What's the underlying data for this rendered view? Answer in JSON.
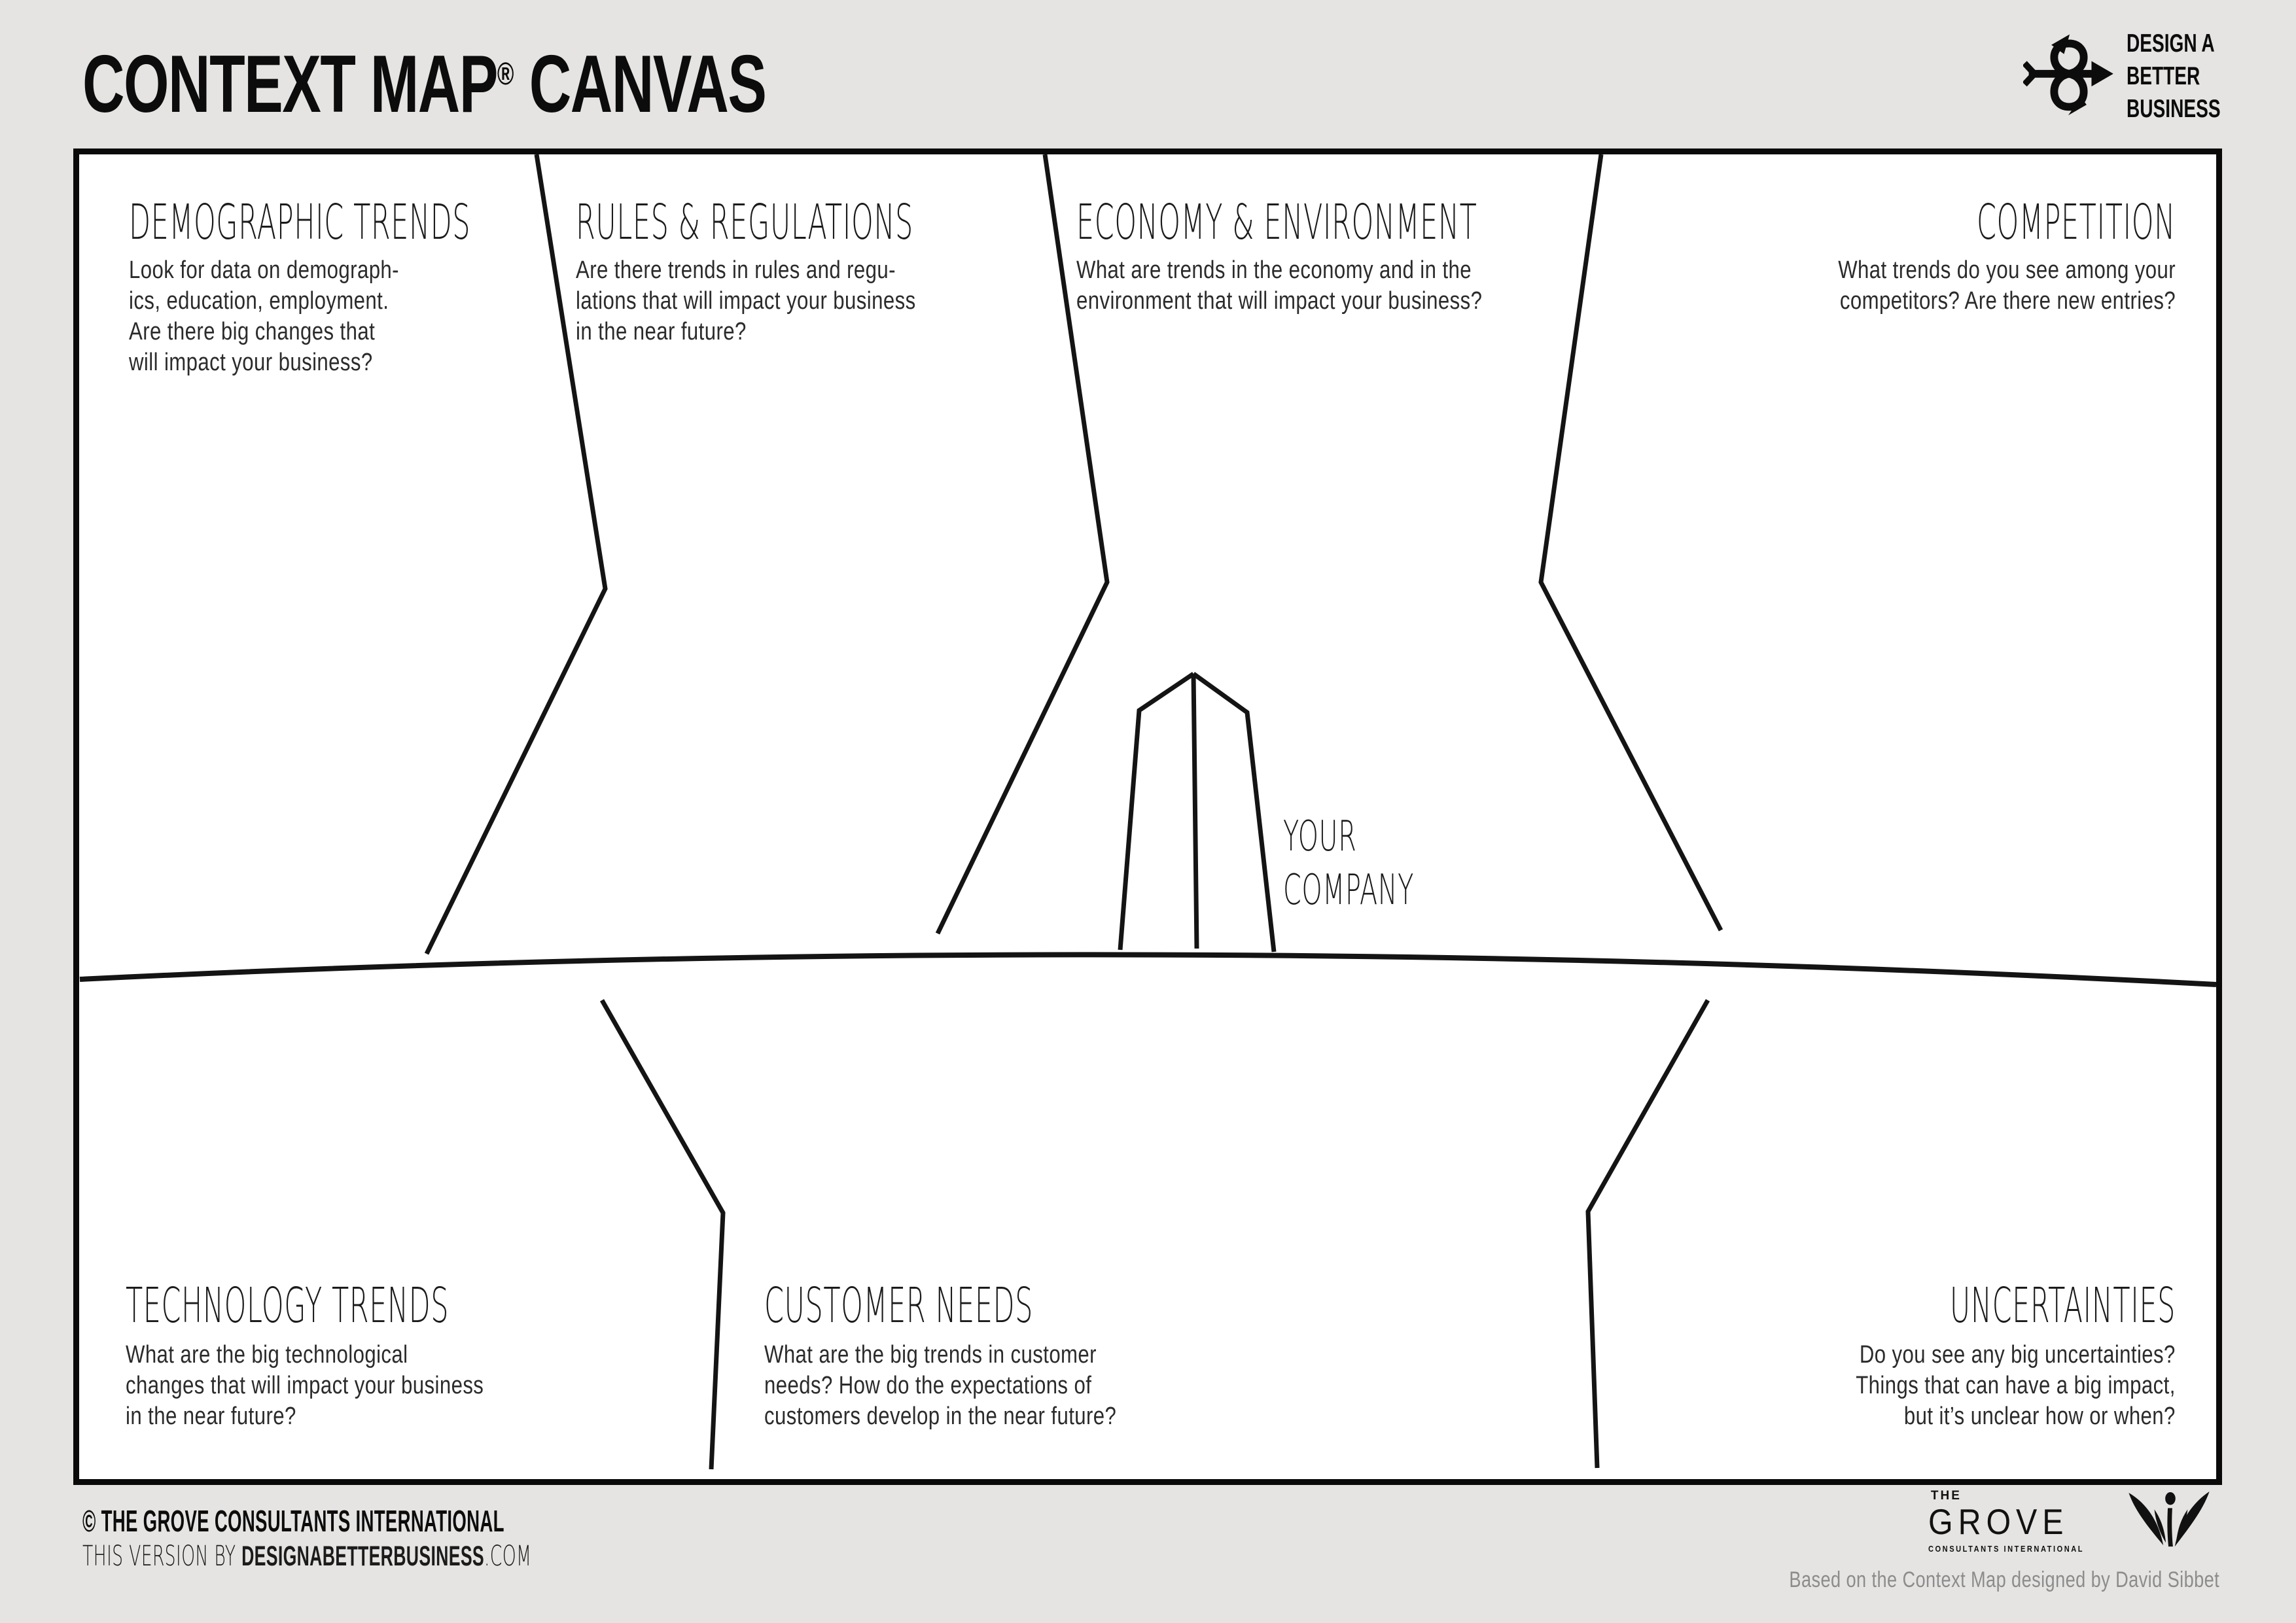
{
  "colors": {
    "background": "#e5e4e2",
    "canvas": "#ffffff",
    "line": "#141414",
    "text": "#1d1d1d",
    "credit_gray": "#8c8c8c"
  },
  "header": {
    "title_main": "CONTEXT MAP",
    "registered": "®",
    "title_tail": " CANVAS"
  },
  "brand": {
    "icon": "infinity-arrows-icon",
    "lines": [
      "DESIGN A",
      "BETTER",
      "BUSINESS"
    ]
  },
  "sections": {
    "demographic": {
      "title": "DEMOGRAPHIC TRENDS",
      "body": "Look for data on demograph-\nics, education, employment.\nAre there big changes that\nwill impact your business?"
    },
    "rules": {
      "title": "RULES & REGULATIONS",
      "body": "Are there trends in rules and regu-\nlations that will impact your business\nin the near future?"
    },
    "economy": {
      "title": "ECONOMY & ENVIRONMENT",
      "body": "What are trends in the economy and in the\nenvironment that will impact your business?"
    },
    "competition": {
      "title": "COMPETITION",
      "body": "What trends do you see among your\ncompetitors? Are there new entries?"
    },
    "technology": {
      "title": "TECHNOLOGY TRENDS",
      "body": "What are the big technological\nchanges that will impact your business\nin the near future?"
    },
    "customer": {
      "title": "CUSTOMER NEEDS",
      "body": "What are the big trends in customer\nneeds? How do the expectations of\ncustomers develop in the near future?"
    },
    "uncertainties": {
      "title": "UNCERTAINTIES",
      "body": "Do you see any big uncertainties?\nThings that can have a big impact,\nbut it’s unclear how or when?"
    }
  },
  "center": {
    "label": "YOUR\nCOMPANY"
  },
  "footer": {
    "copyright": "© THE GROVE CONSULTANTS INTERNATIONAL",
    "version_prefix": "THIS VERSION BY ",
    "version_brand": "DESIGNABETTERBUSINESS",
    "version_suffix": ".COM",
    "credit": "Based on the Context Map designed by David Sibbet"
  },
  "grove": {
    "the": "THE",
    "name": "GROVE",
    "tagline": "CONSULTANTS INTERNATIONAL",
    "icon": "grove-leaves-icon"
  }
}
